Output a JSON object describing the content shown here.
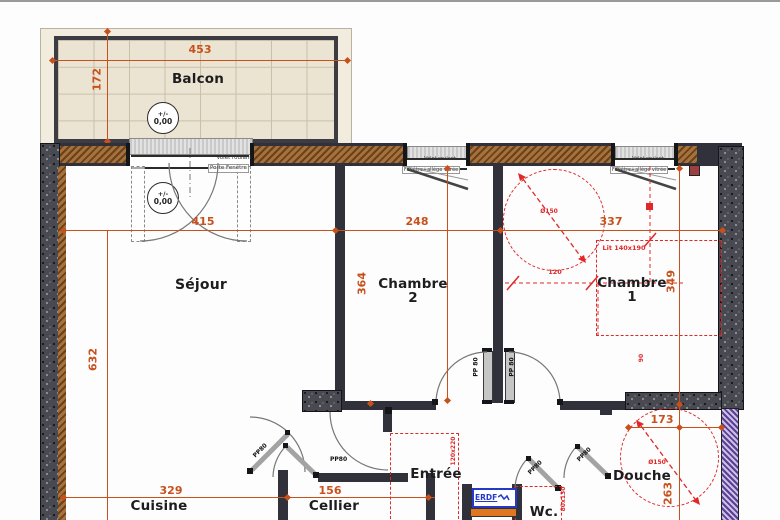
{
  "colors": {
    "dimension": "#c8511b",
    "annotation_red": "#e02828",
    "wall": "#30313a",
    "hatch_brown": "#8a5a2e",
    "insulation_purple": "#6a4d9e",
    "balcony_tile": "#ece4d2",
    "erdf_blue": "#2239c9",
    "erdf_orange": "#e0761f"
  },
  "rooms": {
    "balcon": "Balcon",
    "sejour": "Séjour",
    "chambre2": "Chambre 2",
    "chambre1": "Chambre 1",
    "entree": "Entrée",
    "cuisine": "Cuisine",
    "cellier": "Cellier",
    "wc": "Wc.",
    "douche": "Douche"
  },
  "dimensions": {
    "balcony_width": "453",
    "balcony_depth": "172",
    "sejour_width": "415",
    "chambre2_width": "248",
    "chambre1_width": "337",
    "chambre2_depth": "364",
    "chambre1_depth": "349",
    "sejour_depth": "632",
    "cuisine_width": "329",
    "cellier_width": "156",
    "douche_width": "173",
    "douche_depth": "263",
    "bed_clearance": "120",
    "door_clearance": "90"
  },
  "level_marker": {
    "sign": "+/-",
    "value": "0,00"
  },
  "openings": {
    "roller_shutter": "Volet roulant",
    "french_door": "Porte Fenêtre",
    "window_sill": "Fenêtre+allège vitrée",
    "door_80": "PP80",
    "door_80_spaced": "PP 80"
  },
  "fixtures": {
    "bed": "Lit 140x190",
    "clearance_circle": "Ø150",
    "utility": "ERDF",
    "closet": "120x220",
    "wc_fixture": "80x130"
  }
}
